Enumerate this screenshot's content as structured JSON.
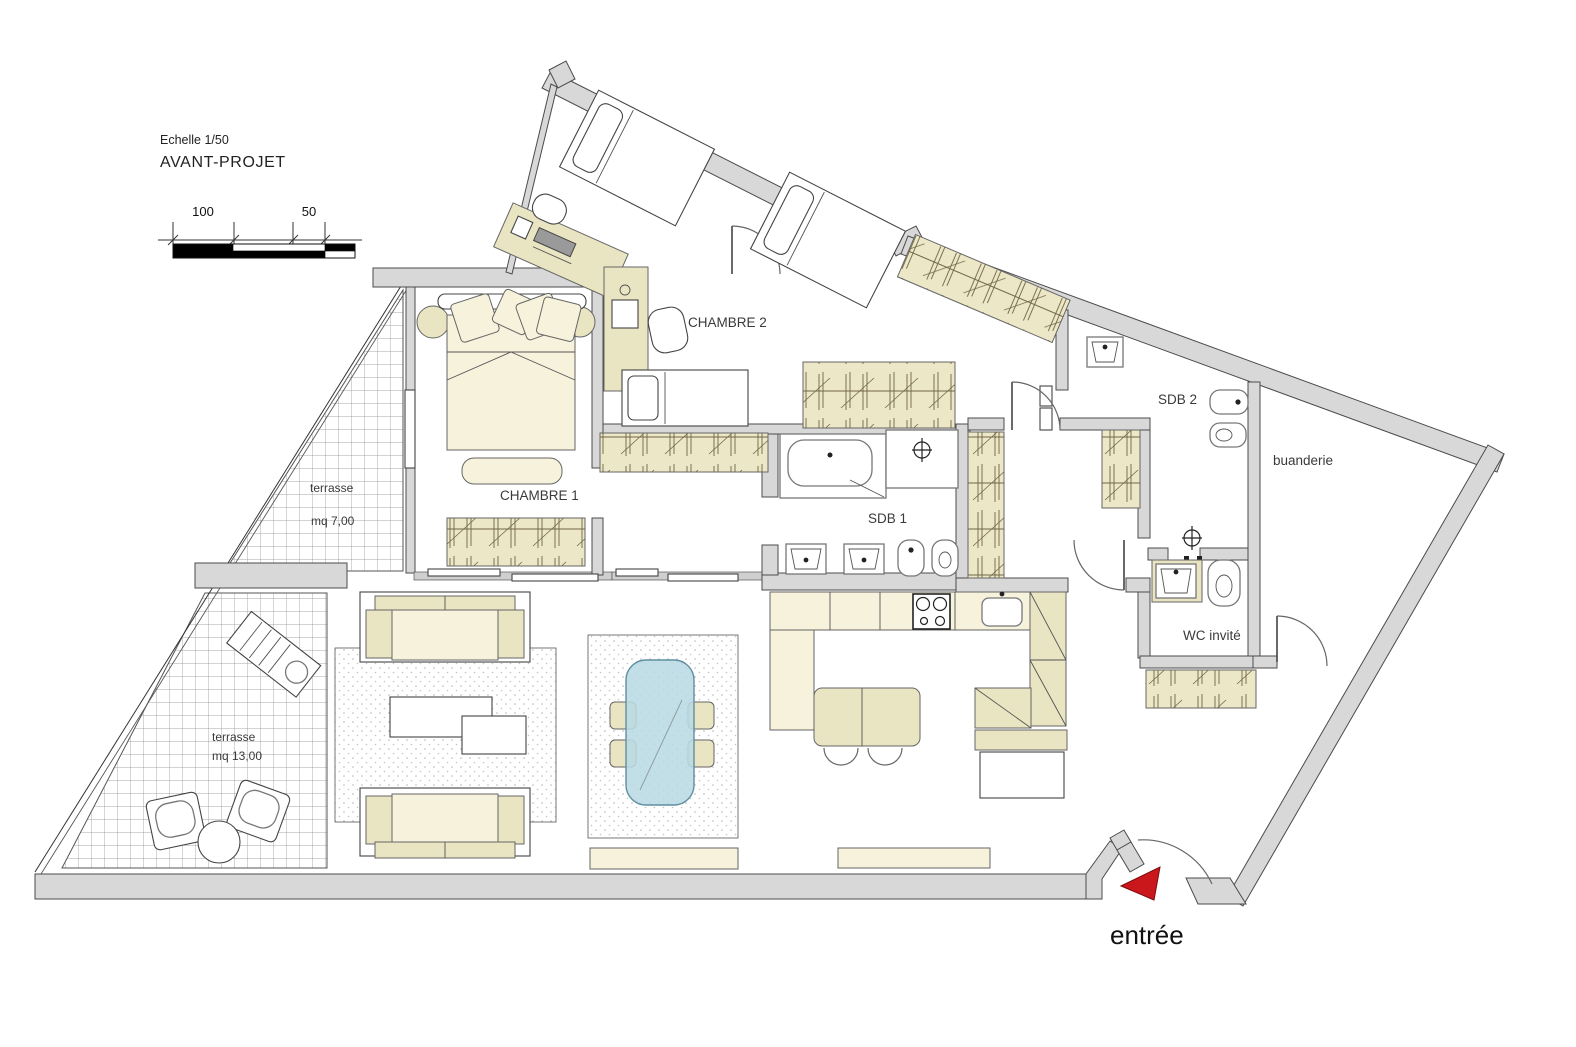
{
  "title_block": {
    "scale_label": "Echelle 1/50",
    "project_label": "AVANT-PROJET",
    "scale_100": "100",
    "scale_50": "50"
  },
  "rooms": {
    "chambre1": "CHAMBRE 1",
    "chambre2": "CHAMBRE 2",
    "sdb1": "SDB 1",
    "sdb2": "SDB 2",
    "buanderie": "buanderie",
    "wc_invite": "WC invité",
    "terrasse_upper": {
      "name": "terrasse",
      "area": "mq 7,00"
    },
    "terrasse_lower": {
      "name": "terrasse",
      "area": "mq 13,00"
    },
    "entree": "entrée"
  },
  "colors": {
    "wall_fill": "#d8d8d8",
    "wall_stroke": "#4b4b4b",
    "furniture_cream": "#f6f2dc",
    "furniture_tan": "#e9e4c2",
    "wardrobe_line": "#6f6545",
    "glass_blue": "#b9d9e4",
    "arrow_red": "#c9171c",
    "label_text": "#3a3a3a"
  }
}
